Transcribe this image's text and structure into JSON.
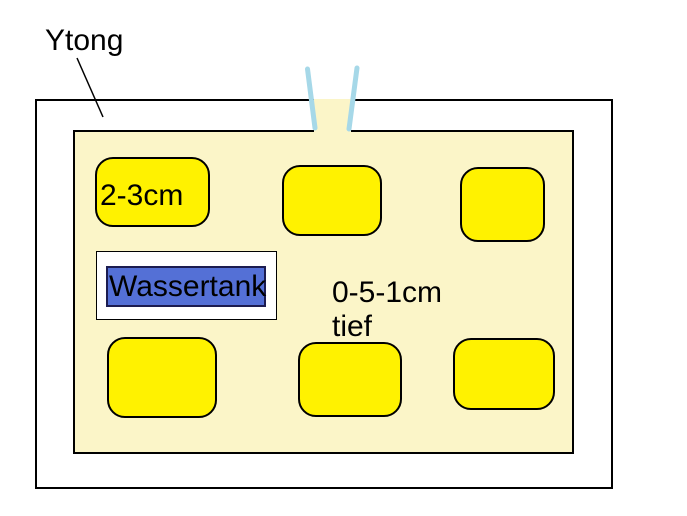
{
  "diagram": {
    "title_label": "Ytong",
    "pocket_depth_label": "2-3cm",
    "tank_label": "Wassertank",
    "depth_note_line1": "0-5-1cm",
    "depth_note_line2": "tief",
    "pocket_count": 6
  },
  "colors": {
    "page_background": "#ffffff",
    "block_face_fill": "#fbf5c8",
    "pocket_fill": "#fff200",
    "selection_blue": "#5470d6",
    "selection_border": "#1c1c50",
    "tube_blue": "#a6d8e8",
    "outline_black": "#000000"
  }
}
